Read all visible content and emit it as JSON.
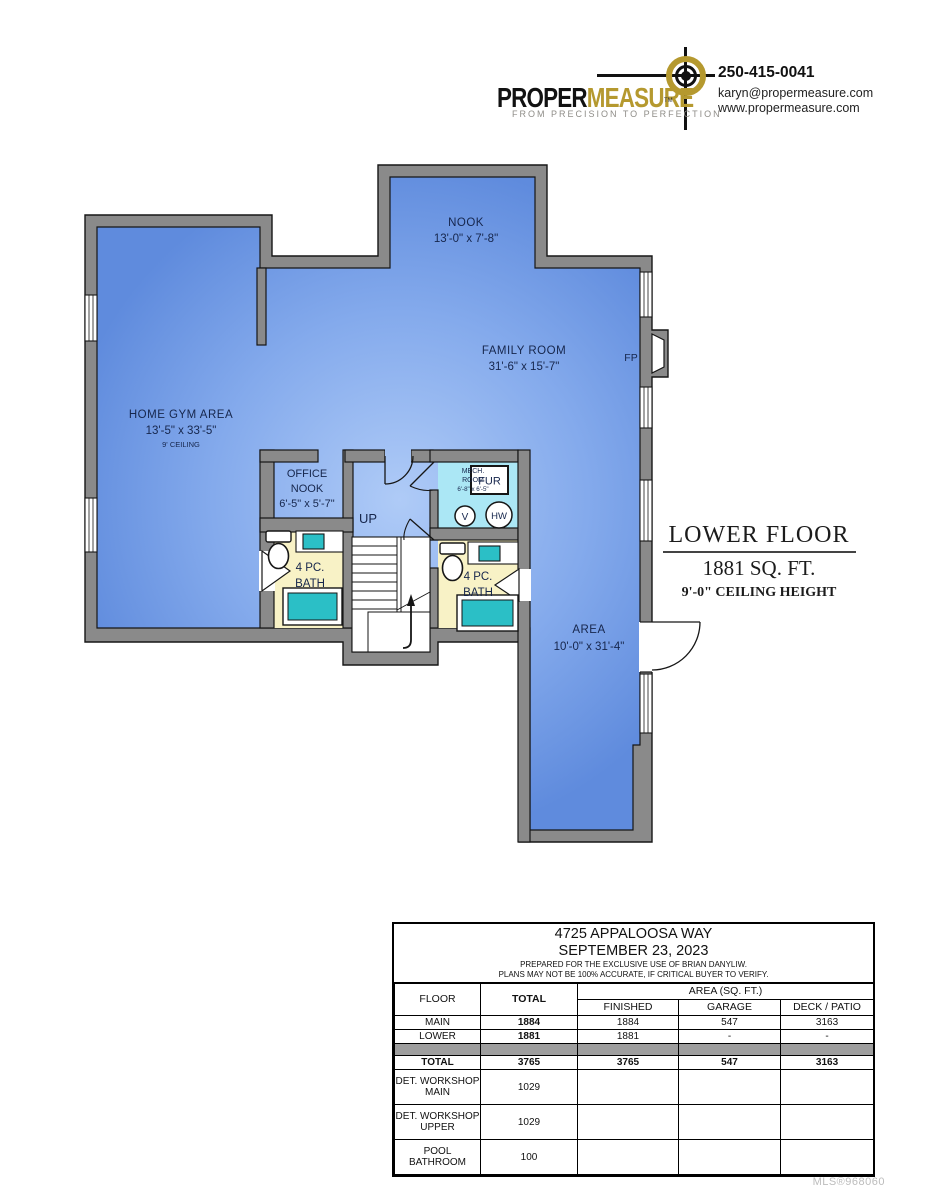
{
  "header": {
    "logo": {
      "name_black": "PROPER",
      "name_gold": "MEASURE",
      "tm": "TM",
      "tagline": "FROM PRECISION TO PERFECTION"
    },
    "contact": {
      "phone": "250-415-0041",
      "email": "karyn@propermeasure.com",
      "website": "www.propermeasure.com"
    }
  },
  "plan": {
    "nook": {
      "name": "NOOK",
      "dims": "13'-0\" x 7'-8\""
    },
    "family": {
      "name": "FAMILY ROOM",
      "dims": "31'-6\" x 15'-7\""
    },
    "fp": "FP",
    "gym": {
      "name": "HOME GYM AREA",
      "dims": "13'-5\" x 33'-5\"",
      "note": "9' CEILING"
    },
    "office": {
      "l1": "OFFICE",
      "l2": "NOOK",
      "dims": "6'-5\" x 5'-7\""
    },
    "up": "UP",
    "mech": {
      "l1": "MECH.",
      "l2": "ROOM",
      "dims": "6'-8\" x 6'-5\"",
      "fur": "FUR",
      "v": "V",
      "hw": "HW"
    },
    "bath_left": {
      "l1": "4 PC.",
      "l2": "BATH"
    },
    "bath_right": {
      "l1": "4 PC.",
      "l2": "BATH"
    },
    "area": {
      "name": "AREA",
      "dims": "10'-0\" x 31'-4\""
    }
  },
  "title_block": {
    "floor": "LOWER FLOOR",
    "area": "1881 SQ. FT.",
    "ceiling": "9'-0\" CEILING HEIGHT"
  },
  "table": {
    "title_lines": {
      "address": "4725 APPALOOSA WAY",
      "date": "SEPTEMBER 23, 2023",
      "note1": "PREPARED FOR THE EXCLUSIVE USE OF BRIAN DANYLIW.",
      "note2": "PLANS MAY NOT BE 100% ACCURATE, IF CRITICAL BUYER TO VERIFY."
    },
    "headers": {
      "floor": "FLOOR",
      "total": "TOTAL",
      "area_group": "AREA (SQ. FT.)",
      "finished": "FINISHED",
      "garage": "GARAGE",
      "deck": "DECK / PATIO"
    },
    "rows": {
      "main": {
        "label": "MAIN",
        "total": "1884",
        "finished": "1884",
        "garage": "547",
        "deck": "3163"
      },
      "lower": {
        "label": "LOWER",
        "total": "1881",
        "finished": "1881",
        "garage": "-",
        "deck": "-"
      },
      "total": {
        "label": "TOTAL",
        "total": "3765",
        "finished": "3765",
        "garage": "547",
        "deck": "3163"
      },
      "ws_main": {
        "label": "DET. WORKSHOP MAIN",
        "total": "1029"
      },
      "ws_upper": {
        "label": "DET. WORKSHOP UPPER",
        "total": "1029"
      },
      "pool": {
        "label": "POOL BATHROOM",
        "total": "100"
      }
    }
  },
  "footer": {
    "mls": "MLS®968060"
  },
  "colors": {
    "brand_gold": "#B5992F",
    "wall_gray": "#8A8A8A",
    "floor_blue": "#7EA5EA",
    "bath_yellow": "#F8F2C6",
    "mech_cyan": "#ABE7F5",
    "fixture_teal": "#2BBFC6"
  }
}
